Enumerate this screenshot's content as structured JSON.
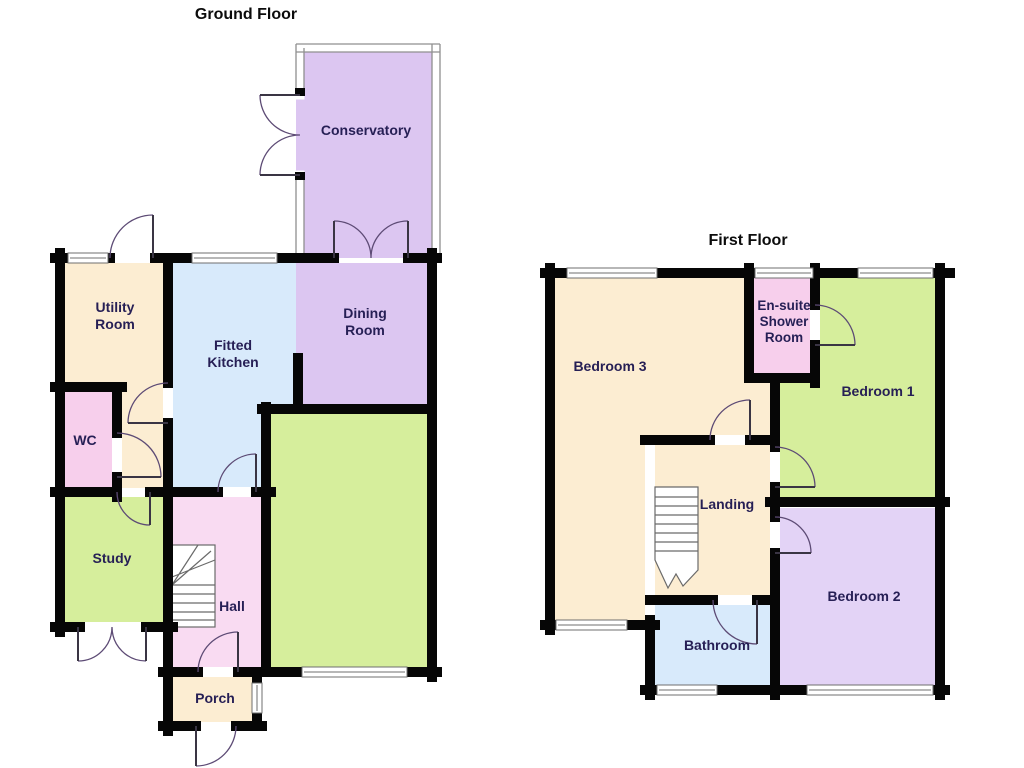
{
  "colors": {
    "background": "#ffffff",
    "wall": "#060606",
    "glass_frame": "#8f8f8f",
    "window_frame": "#6f6f6f",
    "door_arc": "#5d4b75",
    "door_leaf": "#3a3544",
    "stair_line": "#6a6a6a",
    "cream": "#fcedd2",
    "blue": "#d8eafb",
    "pink": "#f7cfec",
    "hall_pink": "#f9dbf2",
    "green": "#d6ee9c",
    "lavender": "#dcc6f1",
    "lavender_light": "#e3d3f6",
    "label": "#261f55",
    "title": "#0c0c0c"
  },
  "ground_floor": {
    "title": "Ground Floor",
    "rooms": {
      "conservatory": {
        "lines": [
          "Conservatory"
        ]
      },
      "utility_room": {
        "lines": [
          "Utility",
          "Room"
        ]
      },
      "fitted_kitchen": {
        "lines": [
          "Fitted",
          "Kitchen"
        ]
      },
      "dining_room": {
        "lines": [
          "Dining",
          "Room"
        ]
      },
      "wc": {
        "lines": [
          "WC"
        ]
      },
      "study": {
        "lines": [
          "Study"
        ]
      },
      "hall": {
        "lines": [
          "Hall"
        ]
      },
      "porch": {
        "lines": [
          "Porch"
        ]
      }
    }
  },
  "first_floor": {
    "title": "First Floor",
    "rooms": {
      "bedroom_3": {
        "lines": [
          "Bedroom 3"
        ]
      },
      "en_suite_shower_room": {
        "lines": [
          "En-suite",
          "Shower",
          "Room"
        ]
      },
      "bedroom_1": {
        "lines": [
          "Bedroom 1"
        ]
      },
      "landing": {
        "lines": [
          "Landing"
        ]
      },
      "bedroom_2": {
        "lines": [
          "Bedroom 2"
        ]
      },
      "bathroom": {
        "lines": [
          "Bathroom"
        ]
      }
    }
  }
}
